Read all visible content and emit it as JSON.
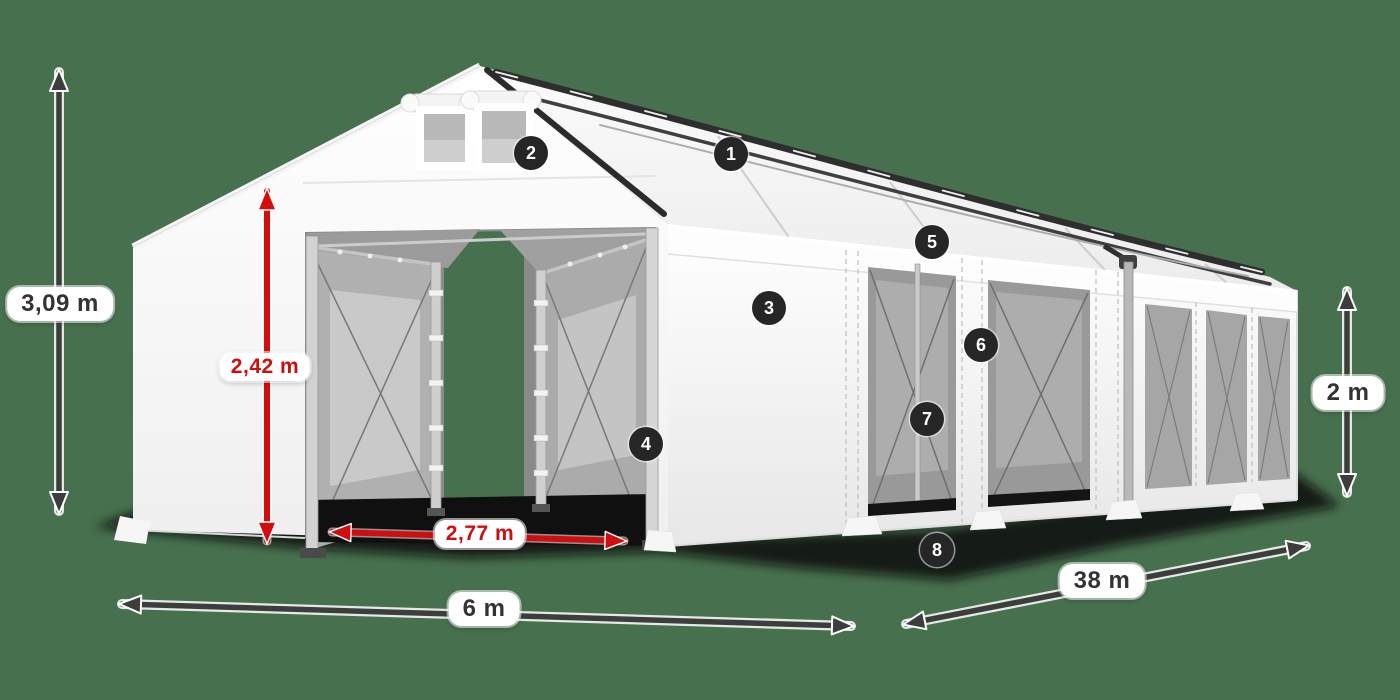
{
  "scene": {
    "type": "annotated-product-diagram",
    "subject": "white PVC marquee storage tent, three-quarter view, with numbered part callouts and dimension arrows"
  },
  "colors": {
    "background": "#47704E",
    "tent_white": "#FFFFFF",
    "window_gray": "#9C9C9C",
    "dimension_arrow_dark": "#3D3D3D",
    "dimension_red": "#D10D0D",
    "badge_background": "#262626",
    "badge_text": "#FFFFFF",
    "label_background": "#FFFFFF",
    "label_text": "#333333"
  },
  "dimensions": {
    "total_height": "3,09 m",
    "entrance_height": "2,42 m",
    "entrance_width": "2,77 m",
    "gable_width": "6 m",
    "length": "38 m",
    "side_height": "2 m"
  },
  "callouts": [
    "1",
    "2",
    "3",
    "4",
    "5",
    "6",
    "7",
    "8"
  ]
}
